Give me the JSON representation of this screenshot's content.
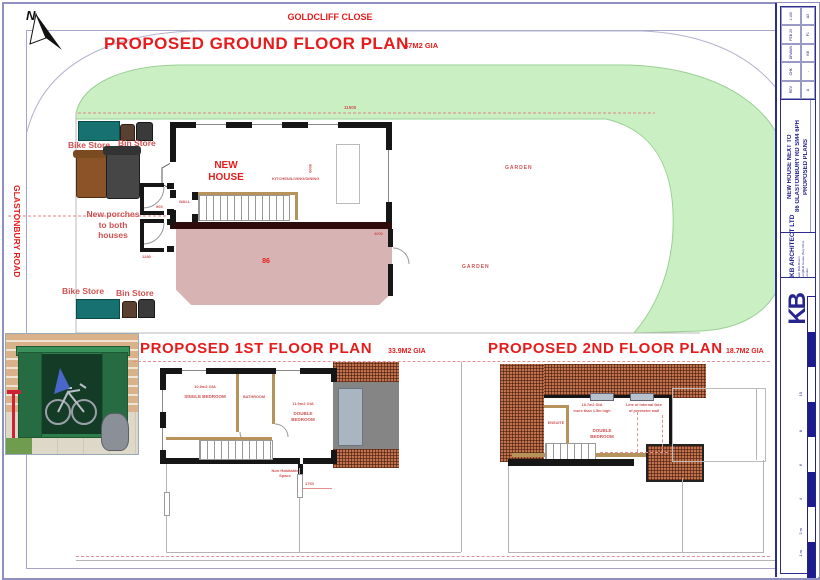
{
  "sheet": {
    "north": "N",
    "road_top": "GOLDCLIFF CLOSE",
    "road_left": "GLASTONBURY ROAD"
  },
  "ground": {
    "title": "PROPOSED GROUND FLOOR PLAN",
    "gia": "47M2 GIA",
    "bike_store_top": "Bike Store",
    "bin_store_top": "Bin Store",
    "bike_store_bottom": "Bike Store",
    "bin_store_bottom": "Bin Store",
    "new_house": "NEW HOUSE",
    "kitchen": "KITCHEN/LIVING/DINING",
    "porches": "New porches to both houses",
    "wall": "WALL",
    "house_number": "86",
    "garden_upper": "GARDEN",
    "garden_lower": "GARDEN",
    "dims": {
      "width": "11500",
      "depth": "9000",
      "right": "4000",
      "porch": "900",
      "porch2": "1280"
    }
  },
  "first": {
    "title": "PROPOSED 1ST FLOOR PLAN",
    "gia": "33.9M2 GIA",
    "single_gia": "10.9m2 GIA",
    "single": "SINGLE BEDROOM",
    "bathroom": "BATHROOM",
    "double_gia": "11.9m2 GIA",
    "double": "DOUBLE BEDROOM",
    "non_habitable": "Non Habitable Space",
    "dim": "1760"
  },
  "second": {
    "title": "PROPOSED 2ND FLOOR PLAN",
    "gia": "18.7M2 GIA",
    "ensuite": "ENSUITE",
    "double": "DOUBLE BEDROOM",
    "gia_note_1": "18.7m2 GIA",
    "gia_note_2": "more than 1.5m high",
    "wall_note_1": "Line of internal face",
    "wall_note_2": "of perimeter wall"
  },
  "title_block": {
    "firm": "KB ARCHITECT LTD",
    "logo": "KB",
    "contact1": "Sam Bell-Brown",
    "contact2": "Longfield House, Bury Drive",
    "contact3": "London",
    "project_line1": "NEW HOUSE NEXT TO",
    "project_line2": "86 GLASTONBURY RD SM4 6PH",
    "drawing_title": "PROPOSED PLANS",
    "rev": [
      [
        "1:100",
        "A3"
      ],
      [
        "FEB 23",
        "P1"
      ],
      [
        "DRAWN",
        "KB"
      ],
      [
        "CHK",
        "-"
      ],
      [
        "REV",
        "A"
      ]
    ]
  },
  "scale_bar": {
    "labels": [
      "1 m",
      "2 m",
      "4",
      "6",
      "8",
      "10"
    ]
  }
}
